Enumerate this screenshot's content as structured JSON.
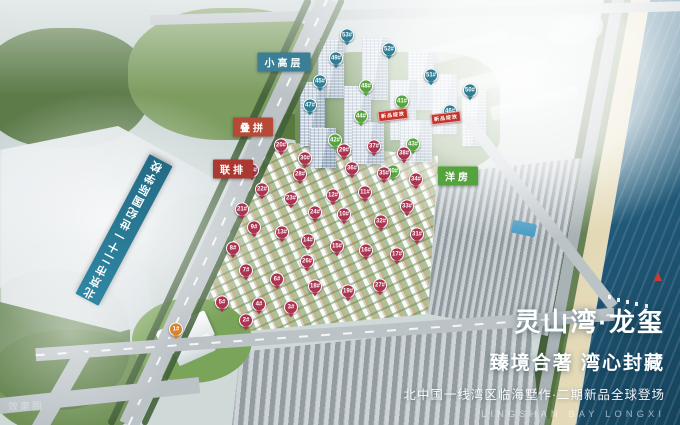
{
  "branding": {
    "title": "灵山湾·龙玺",
    "subtitle": "臻境合著 湾心封藏",
    "tagline": "北中国一线湾区临海墅作·二期新品全球登场",
    "english": "LINGSHAN BAY LONGXI"
  },
  "watermark": "效果图",
  "school_banner": "北京市二十一世纪国际学校",
  "zone_labels": [
    {
      "id": "small-highrise",
      "text": "小高层",
      "bg": "#3a7f95",
      "x": 284,
      "y": 62
    },
    {
      "id": "stacked-townhouse",
      "text": "叠拼",
      "bg": "#b64a37",
      "x": 253,
      "y": 127
    },
    {
      "id": "row-townhouse",
      "text": "联排",
      "bg": "#aa3931",
      "x": 233,
      "y": 169
    },
    {
      "id": "garden-flats",
      "text": "洋房",
      "bg": "#55a33c",
      "x": 458,
      "y": 176
    }
  ],
  "promo_banners": [
    {
      "text": "新品绽放",
      "x": 393,
      "y": 115
    },
    {
      "text": "新品绽放",
      "x": 446,
      "y": 118
    }
  ],
  "markers": {
    "tower_badges": [
      {
        "num": "53#",
        "x": 347,
        "y": 37,
        "color": "teal"
      },
      {
        "num": "52#",
        "x": 389,
        "y": 51,
        "color": "teal"
      },
      {
        "num": "49#",
        "x": 336,
        "y": 60,
        "color": "teal"
      },
      {
        "num": "51#",
        "x": 431,
        "y": 77,
        "color": "teal"
      },
      {
        "num": "45#",
        "x": 320,
        "y": 83,
        "color": "teal"
      },
      {
        "num": "48#",
        "x": 366,
        "y": 88,
        "color": "green"
      },
      {
        "num": "50#",
        "x": 470,
        "y": 92,
        "color": "teal"
      },
      {
        "num": "41#",
        "x": 402,
        "y": 103,
        "color": "green"
      },
      {
        "num": "47#",
        "x": 310,
        "y": 107,
        "color": "teal"
      },
      {
        "num": "46#",
        "x": 450,
        "y": 113,
        "color": "teal"
      },
      {
        "num": "44#",
        "x": 361,
        "y": 118,
        "color": "green"
      },
      {
        "num": "42#",
        "x": 335,
        "y": 142,
        "color": "green"
      },
      {
        "num": "43#",
        "x": 413,
        "y": 146,
        "color": "green"
      },
      {
        "num": "40#",
        "x": 393,
        "y": 173,
        "color": "green"
      }
    ],
    "villa_pins": [
      {
        "num": "1#",
        "x": 176,
        "y": 331,
        "color": "orange"
      },
      {
        "num": "2#",
        "x": 246,
        "y": 322
      },
      {
        "num": "3#",
        "x": 291,
        "y": 309
      },
      {
        "num": "4#",
        "x": 259,
        "y": 306
      },
      {
        "num": "5#",
        "x": 222,
        "y": 304
      },
      {
        "num": "6#",
        "x": 277,
        "y": 281
      },
      {
        "num": "7#",
        "x": 246,
        "y": 272
      },
      {
        "num": "8#",
        "x": 233,
        "y": 250
      },
      {
        "num": "9#",
        "x": 254,
        "y": 229
      },
      {
        "num": "10#",
        "x": 344,
        "y": 216
      },
      {
        "num": "11#",
        "x": 365,
        "y": 194
      },
      {
        "num": "12#",
        "x": 333,
        "y": 197
      },
      {
        "num": "13#",
        "x": 282,
        "y": 234
      },
      {
        "num": "14#",
        "x": 308,
        "y": 242
      },
      {
        "num": "15#",
        "x": 337,
        "y": 248
      },
      {
        "num": "16#",
        "x": 366,
        "y": 252
      },
      {
        "num": "17#",
        "x": 397,
        "y": 256
      },
      {
        "num": "18#",
        "x": 315,
        "y": 288
      },
      {
        "num": "19#",
        "x": 348,
        "y": 293
      },
      {
        "num": "20#",
        "x": 281,
        "y": 147
      },
      {
        "num": "21#",
        "x": 242,
        "y": 211
      },
      {
        "num": "22#",
        "x": 262,
        "y": 191
      },
      {
        "num": "23#",
        "x": 291,
        "y": 200
      },
      {
        "num": "24#",
        "x": 315,
        "y": 214
      },
      {
        "num": "25#",
        "x": 252,
        "y": 172
      },
      {
        "num": "26#",
        "x": 307,
        "y": 263
      },
      {
        "num": "27#",
        "x": 380,
        "y": 287
      },
      {
        "num": "28#",
        "x": 300,
        "y": 176
      },
      {
        "num": "29#",
        "x": 344,
        "y": 152
      },
      {
        "num": "30#",
        "x": 305,
        "y": 160
      },
      {
        "num": "31#",
        "x": 417,
        "y": 236
      },
      {
        "num": "32#",
        "x": 381,
        "y": 223
      },
      {
        "num": "33#",
        "x": 407,
        "y": 208
      },
      {
        "num": "34#",
        "x": 416,
        "y": 181
      },
      {
        "num": "35#",
        "x": 384,
        "y": 175
      },
      {
        "num": "36#",
        "x": 352,
        "y": 170
      },
      {
        "num": "37#",
        "x": 374,
        "y": 148
      },
      {
        "num": "38#",
        "x": 404,
        "y": 155
      }
    ]
  },
  "colors": {
    "sea": "#2f6e8f",
    "pin_red": "#ab3450",
    "badge_teal": "#2f7e95",
    "badge_green": "#58a53e",
    "promo_red": "#c3342c",
    "school_teal": "#2c7d99"
  }
}
